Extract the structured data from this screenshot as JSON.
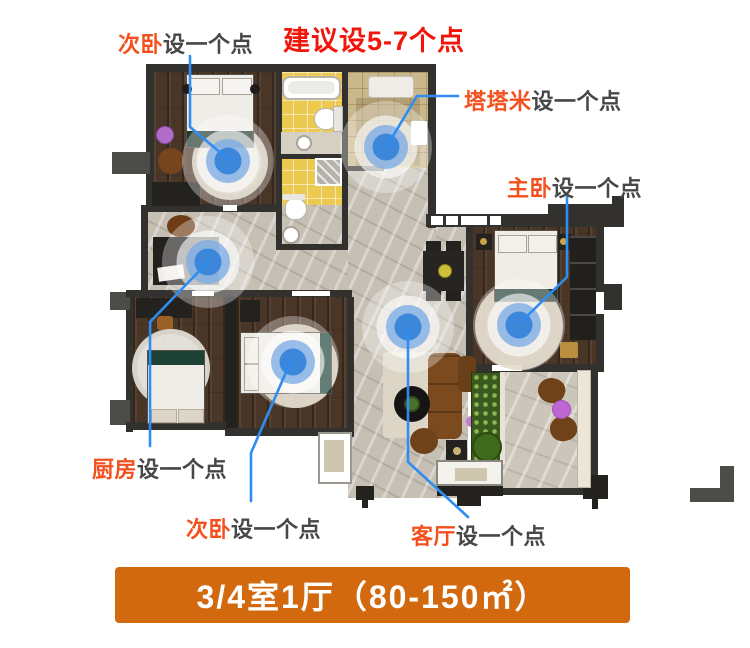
{
  "title": {
    "text": "建议设5-7个点"
  },
  "annotations": [
    {
      "room": "次卧",
      "note": "设一个点"
    },
    {
      "room": "塔塔米",
      "note": "设一个点"
    },
    {
      "room": "主卧",
      "note": "设一个点"
    },
    {
      "room": "厨房",
      "note": "设一个点"
    },
    {
      "room": "次卧",
      "note": "设一个点"
    },
    {
      "room": "客厅",
      "note": "设一个点"
    }
  ],
  "banner": {
    "text": "3/4室1厅（80-150㎡）"
  },
  "markers": {
    "count": 6
  },
  "colors": {
    "title_red": "#f2150a",
    "room_keyword_orange": "#f4501d",
    "note_gray": "#474747",
    "connector_blue": "#2f8df2",
    "marker_blue": "#3c87da",
    "banner_orange": "#d2690f",
    "banner_text": "#ffffff"
  }
}
